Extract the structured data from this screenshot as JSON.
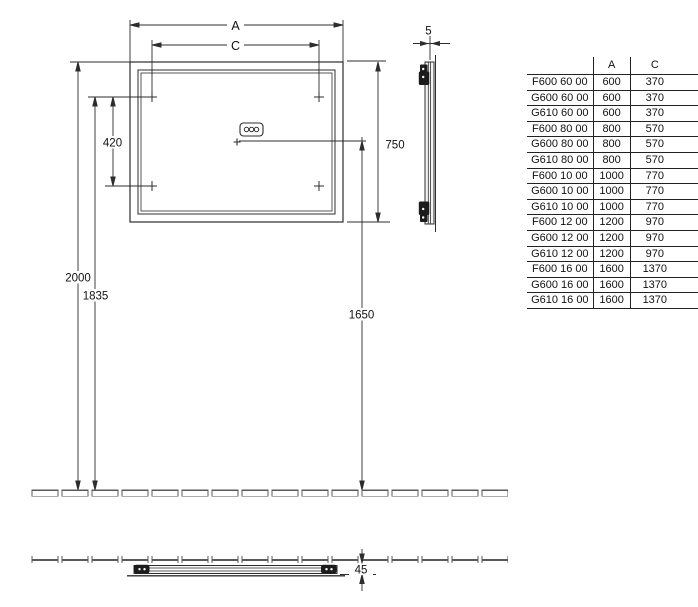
{
  "drawing_type": "mirror installation technical drawing",
  "dimensions": {
    "width_label": "A",
    "hole_spacing_label": "C",
    "hole_vertical_spacing": "420",
    "mirror_height": "750",
    "top_edge_height": "2000",
    "mounting_hole_height": "1835",
    "junction_box_height": "1650",
    "glass_thickness": "5",
    "wall_depth": "45"
  },
  "table": {
    "headers": {
      "model": "",
      "a": "A",
      "c": "C"
    },
    "rows": [
      {
        "model": "F600 60 00",
        "a": "600",
        "c": "370"
      },
      {
        "model": "G600 60 00",
        "a": "600",
        "c": "370"
      },
      {
        "model": "G610 60 00",
        "a": "600",
        "c": "370"
      },
      {
        "model": "F600 80 00",
        "a": "800",
        "c": "570"
      },
      {
        "model": "G600 80 00",
        "a": "800",
        "c": "570"
      },
      {
        "model": "G610 80 00",
        "a": "800",
        "c": "570"
      },
      {
        "model": "F600 10 00",
        "a": "1000",
        "c": "770"
      },
      {
        "model": "G600 10 00",
        "a": "1000",
        "c": "770"
      },
      {
        "model": "G610 10 00",
        "a": "1000",
        "c": "770"
      },
      {
        "model": "F600 12 00",
        "a": "1200",
        "c": "970"
      },
      {
        "model": "G600 12 00",
        "a": "1200",
        "c": "970"
      },
      {
        "model": "G610 12 00",
        "a": "1200",
        "c": "970"
      },
      {
        "model": "F600 16 00",
        "a": "1600",
        "c": "1370"
      },
      {
        "model": "G600 16 00",
        "a": "1600",
        "c": "1370"
      },
      {
        "model": "G610 16 00",
        "a": "1600",
        "c": "1370"
      }
    ]
  },
  "colors": {
    "line": "#2d2d2d",
    "tile_line": "#5a5a5a",
    "bracket_fill": "#1c1c1c",
    "background": "#ffffff"
  }
}
